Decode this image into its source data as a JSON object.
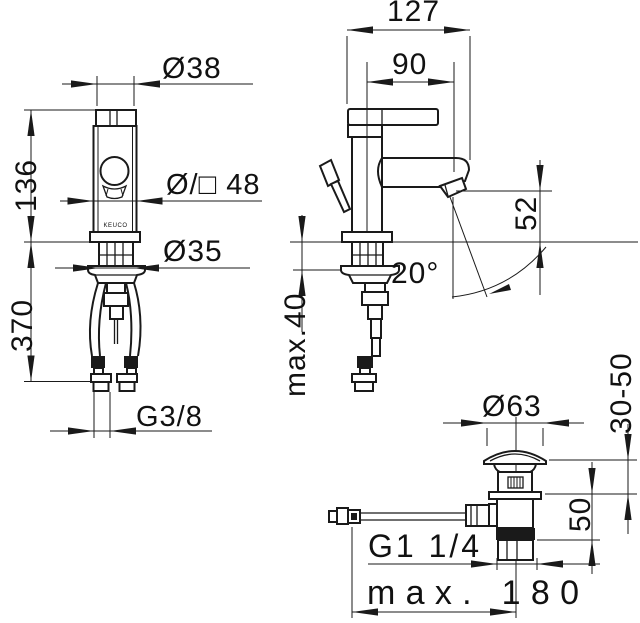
{
  "drawing": {
    "brand": "KEUCO",
    "front": {
      "dia_cartridge": "Ø38",
      "height_to_deck": "136",
      "body_size": "Ø/□ 48",
      "shank_dia": "Ø35",
      "hose_length": "370",
      "hose_thread": "G3/8"
    },
    "side": {
      "total_depth": "127",
      "spout_reach": "90",
      "outlet_height": "52",
      "spout_angle": "20°",
      "deck_thickness": "max.40"
    },
    "drain": {
      "cap_dia": "Ø63",
      "clamp_range": "30-50",
      "body_height": "50",
      "thread": "G1 1/4",
      "rod_reach": "max. 180"
    }
  },
  "colors": {
    "line": "#1a1a1a",
    "background": "#ffffff"
  }
}
